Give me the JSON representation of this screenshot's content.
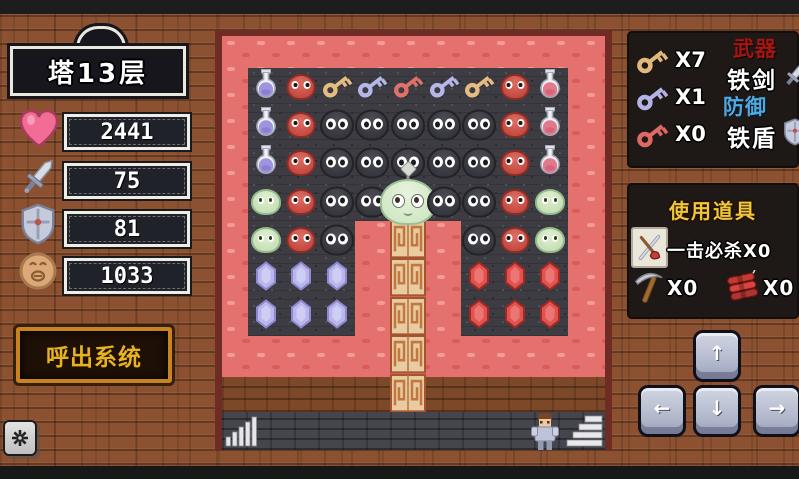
{
  "window": {
    "width": 799,
    "height": 479
  },
  "left_panel": {
    "floor_title": "塔13层",
    "stats": [
      {
        "name": "hp",
        "icon": "heart-icon",
        "value": "2441"
      },
      {
        "name": "attack",
        "icon": "sword-icon",
        "value": "75"
      },
      {
        "name": "defense",
        "icon": "shield-icon",
        "value": "81"
      },
      {
        "name": "gold",
        "icon": "coin-icon",
        "value": "1033"
      }
    ],
    "system_button_label": "呼出系统",
    "settings_key_icon": "gear-icon"
  },
  "right_panel": {
    "keys": [
      {
        "name": "yellow-key",
        "count_label": "X7",
        "color": "#e2b87c"
      },
      {
        "name": "blue-key",
        "count_label": "X1",
        "color": "#b4b4e4"
      },
      {
        "name": "red-key",
        "count_label": "X0",
        "color": "#dd6a62"
      }
    ],
    "equipment": {
      "weapon_label": "武器",
      "weapon_label_color": "#a81410",
      "weapon_name": "铁剑",
      "weapon_icon": "sword-icon",
      "armor_label": "防御",
      "armor_label_color": "#4fa9de",
      "armor_name": "铁盾",
      "armor_icon": "shield-icon"
    },
    "items_panel": {
      "title": "使用道具",
      "items": [
        {
          "name": "one-hit-kill",
          "icon": "crossed-weapons-icon",
          "label": "一击必杀X0"
        },
        {
          "name": "pickaxe",
          "icon": "pickaxe-icon",
          "label": "X0"
        },
        {
          "name": "dynamite",
          "icon": "dynamite-icon",
          "label": "X0"
        }
      ]
    },
    "dpad": {
      "up": "↑",
      "left": "←",
      "down": "↓",
      "right": "→"
    }
  },
  "board": {
    "legend": {
      "pb": "potion-blue",
      "pr": "potion-red",
      "ky": "key-yellow",
      "kb": "key-blue",
      "kr": "key-red",
      "sb": "slime-black",
      "sr": "slime-red",
      "sg": "slime-green",
      "sk": "slime-king",
      "gb": "gem-blue",
      "gr": "gem-red"
    },
    "grid": [
      [
        "pb",
        "sr",
        "ky",
        "kb",
        "kr",
        "kb",
        "ky",
        "sr",
        "pr"
      ],
      [
        "pb",
        "sr",
        "sb",
        "sb",
        "sb",
        "sb",
        "sb",
        "sr",
        "pr"
      ],
      [
        "pb",
        "sr",
        "sb",
        "sb",
        "sb",
        "sb",
        "sb",
        "sr",
        "pr"
      ],
      [
        "sg",
        "sr",
        "sb",
        "sb",
        "sk",
        "sb",
        "sb",
        "sr",
        "sg"
      ],
      [
        "sg",
        "sr",
        "sb",
        "",
        "",
        "",
        "sb",
        "sr",
        "sg"
      ],
      [
        "gb",
        "gb",
        "gb",
        "",
        "",
        "",
        "gr",
        "gr",
        "gr"
      ],
      [
        "gb",
        "gb",
        "gb",
        "",
        "",
        "",
        "gr",
        "gr",
        "gr"
      ]
    ],
    "bottom_icons": [
      "level-bars-icon",
      "hero-sprite",
      "stairs-icon"
    ],
    "pillar_tiles": 5
  },
  "colors": {
    "background_brick": "#8c5130",
    "board_floor_pink": "#e4716e",
    "stone_dark": "#3c3c42",
    "pillar_tan": "#e8cba1",
    "button_frame_orange": "#c8821f",
    "button_text_gold": "#e7b322",
    "items_title_yellow": "#f0c63c"
  }
}
